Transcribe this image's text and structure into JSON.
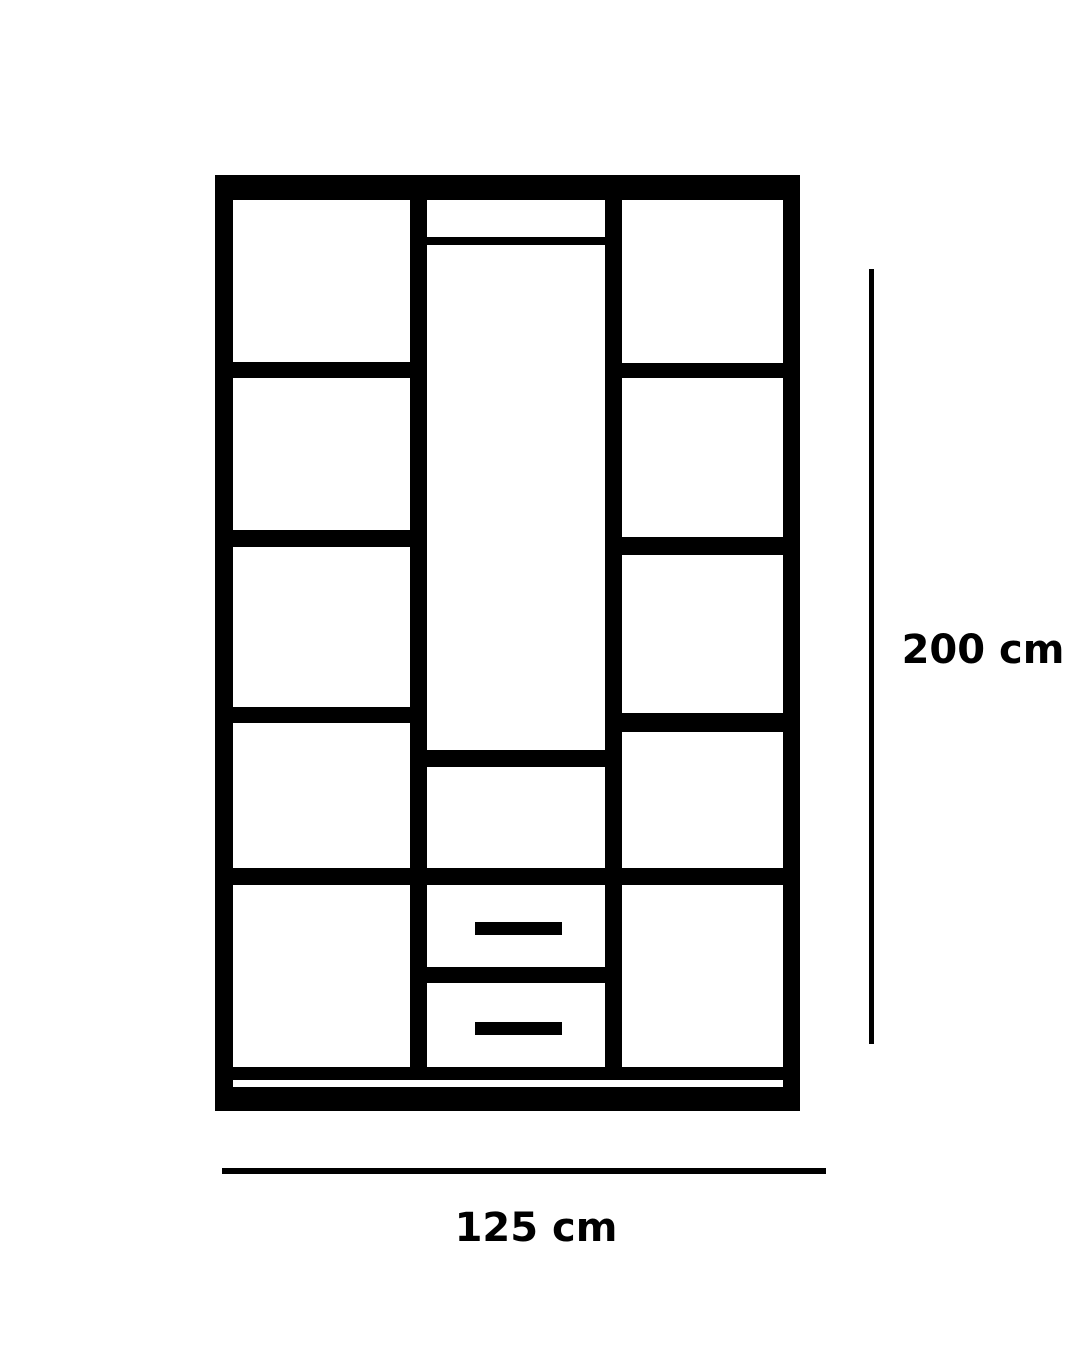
{
  "diagram": {
    "type": "furniture-dimension-diagram",
    "subject": "wardrobe-front-elevation",
    "line_color": "#000000",
    "background_color": "#ffffff",
    "text_color": "#000000",
    "height_dimension": {
      "label": "200 cm",
      "value": 200,
      "unit": "cm"
    },
    "width_dimension": {
      "label": "125 cm",
      "value": 125,
      "unit": "cm"
    },
    "structure": {
      "columns": 3,
      "left_column_compartments": 5,
      "right_column_compartments": 5,
      "middle_column_compartments": 3,
      "middle_column_drawers": 2,
      "hanging_rail": 1,
      "plinth": 1
    }
  }
}
